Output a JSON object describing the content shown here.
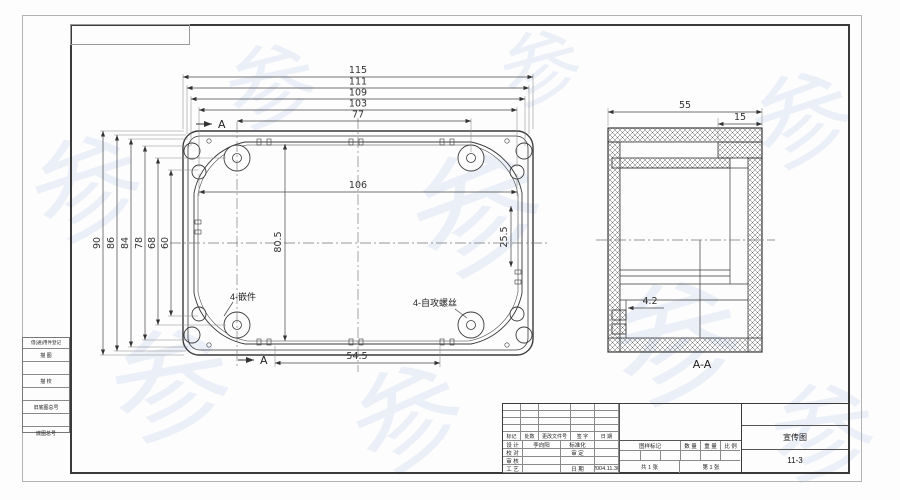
{
  "colors": {
    "line": "#3a3a3a",
    "watermark": "#688cd6"
  },
  "watermark": {
    "chars": [
      "参",
      "参",
      "参",
      "参",
      "参",
      "参",
      "参",
      "参",
      "参"
    ]
  },
  "drawing": {
    "plan_view": {
      "dims_top": [
        "115",
        "111",
        "109",
        "103",
        "77"
      ],
      "dim_inner_width": "106",
      "dims_left": [
        "90",
        "86",
        "84",
        "78",
        "68",
        "60"
      ],
      "dim_inner_height": "80.5",
      "dim_right_inner": "25.5",
      "dim_bottom": "54.5",
      "label_insert": "4-嵌件",
      "label_screw": "4-自攻螺丝",
      "section_marker": "A"
    },
    "section_view": {
      "dim_width": "55",
      "dim_step": "15",
      "dim_detail": "4.2",
      "label": "A-A"
    }
  },
  "side_strip": {
    "rows": [
      "借(通)用件登记",
      "描 图",
      "",
      "描 校",
      "",
      "旧底图总号",
      "",
      "底图总号"
    ]
  },
  "title_block": {
    "revision_headers": [
      "标记",
      "处数",
      "更改文件号",
      "签 字",
      "日 期"
    ],
    "roles": [
      {
        "label": "设 计",
        "name": "李向阳",
        "right_label": "标准化",
        "right_value": ""
      },
      {
        "label": "校 对",
        "name": "",
        "right_label": "审 定",
        "right_value": ""
      },
      {
        "label": "审 核",
        "name": "",
        "right_label": "",
        "right_value": ""
      },
      {
        "label": "工 艺",
        "name": "",
        "right_label": "日 期",
        "right_value": "2004.11.30"
      }
    ],
    "stamp_headers": [
      "图样标记",
      "数 量",
      "重 量",
      "比 例"
    ],
    "sheet_total": "共 1 张",
    "sheet_no": "第 1 张",
    "title": "宣传图",
    "drawing_no": "11-3"
  }
}
